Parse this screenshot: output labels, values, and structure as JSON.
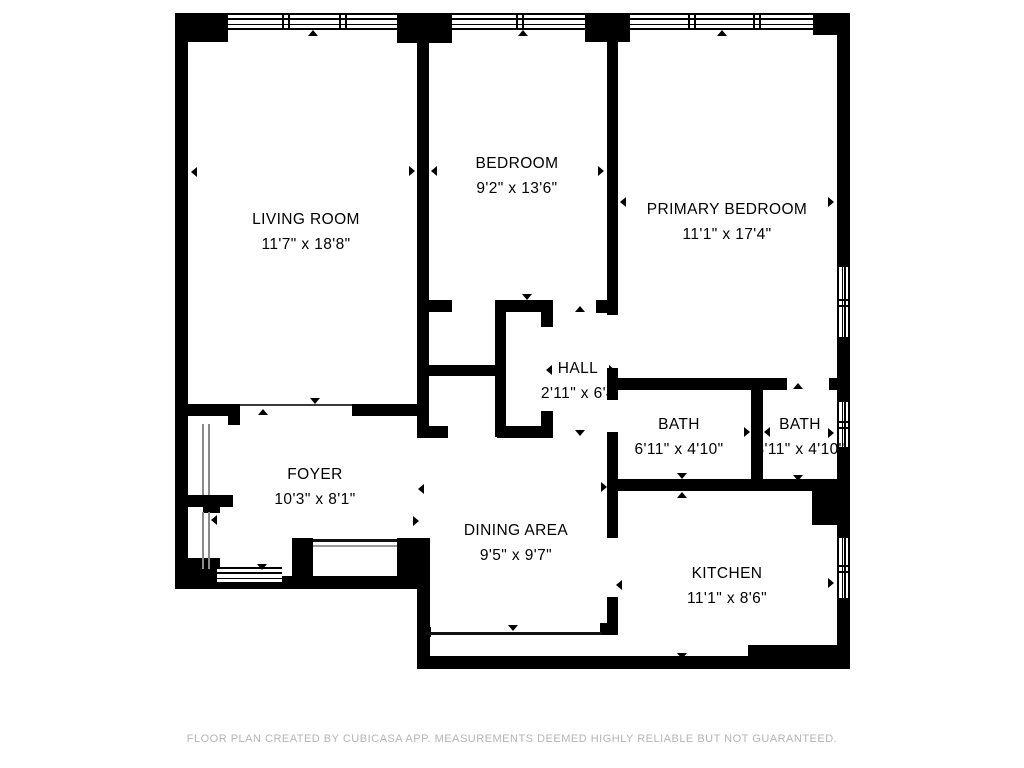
{
  "footer": {
    "text": "FLOOR PLAN CREATED BY CUBICASA APP. MEASUREMENTS DEEMED HIGHLY RELIABLE BUT NOT GUARANTEED."
  },
  "floorplan": {
    "colors": {
      "wall": "#000000",
      "opening_line": "#3a3a3a",
      "closet_line": "#8a8a8a",
      "entry_line": "#111111",
      "entry_line2": "#9a9a9a",
      "window_line": "#111111"
    },
    "rooms": [
      {
        "name": "LIVING ROOM",
        "dims": "11'7\" x 18'8\"",
        "cx": 306,
        "y": 207
      },
      {
        "name": "BEDROOM",
        "dims": "9'2\" x 13'6\"",
        "cx": 517,
        "y": 151
      },
      {
        "name": "PRIMARY BEDROOM",
        "dims": "11'1\" x 17'4\"",
        "cx": 727,
        "y": 197
      },
      {
        "name": "HALL",
        "dims": "2'11\" x 6'4",
        "cx": 578,
        "y": 356
      },
      {
        "name": "BATH",
        "dims": "6'11\" x 4'10\"",
        "cx": 679,
        "y": 412
      },
      {
        "name": "BATH",
        "dims": "3'11\" x 4'10\"",
        "cx": 800,
        "y": 412
      },
      {
        "name": "FOYER",
        "dims": "10'3\" x 8'1\"",
        "cx": 315,
        "y": 462
      },
      {
        "name": "DINING AREA",
        "dims": "9'5\" x 9'7\"",
        "cx": 516,
        "y": 518
      },
      {
        "name": "KITCHEN",
        "dims": "11'1\" x 8'6\"",
        "cx": 727,
        "y": 561
      }
    ],
    "walls": [
      [
        175,
        13,
        53,
        29
      ],
      [
        397,
        13,
        55,
        30
      ],
      [
        585,
        13,
        45,
        29
      ],
      [
        813,
        13,
        37,
        22
      ],
      [
        175,
        13,
        13,
        576
      ],
      [
        837,
        13,
        13,
        254
      ],
      [
        837,
        337,
        13,
        65
      ],
      [
        837,
        447,
        13,
        91
      ],
      [
        837,
        598,
        13,
        71
      ],
      [
        175,
        558,
        45,
        31
      ],
      [
        175,
        576,
        255,
        13
      ],
      [
        292,
        538,
        21,
        38
      ],
      [
        397,
        538,
        33,
        38
      ],
      [
        417,
        538,
        13,
        131
      ],
      [
        417,
        656,
        433,
        13
      ],
      [
        748,
        645,
        102,
        24
      ],
      [
        417,
        30,
        12,
        403
      ],
      [
        607,
        30,
        11,
        285
      ],
      [
        607,
        368,
        11,
        32
      ],
      [
        607,
        432,
        11,
        106
      ],
      [
        607,
        597,
        11,
        38
      ],
      [
        417,
        300,
        35,
        12
      ],
      [
        495,
        300,
        58,
        12
      ],
      [
        541,
        312,
        12,
        15
      ],
      [
        596,
        300,
        22,
        13
      ],
      [
        495,
        300,
        11,
        137
      ],
      [
        417,
        365,
        89,
        11
      ],
      [
        417,
        426,
        31,
        12
      ],
      [
        497,
        426,
        56,
        12
      ],
      [
        541,
        411,
        12,
        15
      ],
      [
        613,
        378,
        174,
        12
      ],
      [
        829,
        378,
        21,
        12
      ],
      [
        751,
        390,
        12,
        90
      ],
      [
        607,
        479,
        205,
        12
      ],
      [
        812,
        479,
        26,
        46
      ],
      [
        188,
        404,
        52,
        12
      ],
      [
        228,
        404,
        12,
        21
      ],
      [
        352,
        404,
        66,
        12
      ],
      [
        188,
        495,
        45,
        12
      ],
      [
        203,
        495,
        17,
        18
      ],
      [
        600,
        623,
        8,
        12
      ],
      [
        423,
        627,
        8,
        10
      ]
    ],
    "windows": [
      {
        "o": "h",
        "x": 228,
        "y": 13,
        "l": 169,
        "t": 17,
        "ticks": [
          54,
          111
        ]
      },
      {
        "o": "h",
        "x": 452,
        "y": 13,
        "l": 133,
        "t": 17,
        "ticks": [
          64
        ]
      },
      {
        "o": "h",
        "x": 630,
        "y": 13,
        "l": 183,
        "t": 17,
        "ticks": [
          58,
          123
        ]
      },
      {
        "o": "v",
        "x": 837,
        "y": 267,
        "l": 70,
        "t": 13,
        "ticks": [
          32
        ]
      },
      {
        "o": "v",
        "x": 837,
        "y": 402,
        "l": 45,
        "t": 13,
        "ticks": [
          19
        ]
      },
      {
        "o": "v",
        "x": 837,
        "y": 538,
        "l": 60,
        "t": 13,
        "ticks": [
          27
        ]
      },
      {
        "o": "h",
        "x": 217,
        "y": 567,
        "l": 65,
        "t": 17,
        "ticks": []
      }
    ],
    "lines": [
      {
        "x": 240,
        "y": 404,
        "w": 112,
        "h": 2,
        "c": "opening_line"
      },
      {
        "x": 202,
        "y": 424,
        "w": 2,
        "h": 71,
        "c": "closet_line"
      },
      {
        "x": 208,
        "y": 424,
        "w": 2,
        "h": 71,
        "c": "closet_line"
      },
      {
        "x": 202,
        "y": 512,
        "w": 2,
        "h": 57,
        "c": "closet_line"
      },
      {
        "x": 208,
        "y": 512,
        "w": 2,
        "h": 57,
        "c": "closet_line"
      },
      {
        "x": 313,
        "y": 539,
        "w": 84,
        "h": 3,
        "c": "entry_line"
      },
      {
        "x": 313,
        "y": 545,
        "w": 84,
        "h": 1.5,
        "c": "entry_line2"
      },
      {
        "x": 425,
        "y": 632,
        "w": 177,
        "h": 3,
        "c": "window_line"
      }
    ],
    "markers": [
      {
        "x": 313,
        "y": 33,
        "d": "up"
      },
      {
        "x": 523,
        "y": 33,
        "d": "up"
      },
      {
        "x": 722,
        "y": 33,
        "d": "up"
      },
      {
        "x": 194,
        "y": 172,
        "d": "left"
      },
      {
        "x": 412,
        "y": 171,
        "d": "right"
      },
      {
        "x": 434,
        "y": 171,
        "d": "left"
      },
      {
        "x": 601,
        "y": 171,
        "d": "right"
      },
      {
        "x": 623,
        "y": 202,
        "d": "left"
      },
      {
        "x": 831,
        "y": 202,
        "d": "right"
      },
      {
        "x": 527,
        "y": 297,
        "d": "down"
      },
      {
        "x": 580,
        "y": 309,
        "d": "up"
      },
      {
        "x": 549,
        "y": 370,
        "d": "left"
      },
      {
        "x": 612,
        "y": 370,
        "d": "right"
      },
      {
        "x": 517,
        "y": 435,
        "d": "up"
      },
      {
        "x": 580,
        "y": 433,
        "d": "down"
      },
      {
        "x": 682,
        "y": 385,
        "d": "up"
      },
      {
        "x": 682,
        "y": 476,
        "d": "down"
      },
      {
        "x": 682,
        "y": 495,
        "d": "up"
      },
      {
        "x": 604,
        "y": 487,
        "d": "right"
      },
      {
        "x": 747,
        "y": 432,
        "d": "right"
      },
      {
        "x": 767,
        "y": 432,
        "d": "left"
      },
      {
        "x": 798,
        "y": 386,
        "d": "up"
      },
      {
        "x": 798,
        "y": 478,
        "d": "down"
      },
      {
        "x": 831,
        "y": 433,
        "d": "right"
      },
      {
        "x": 619,
        "y": 585,
        "d": "left"
      },
      {
        "x": 831,
        "y": 583,
        "d": "right"
      },
      {
        "x": 682,
        "y": 656,
        "d": "down"
      },
      {
        "x": 513,
        "y": 628,
        "d": "down"
      },
      {
        "x": 421,
        "y": 489,
        "d": "left"
      },
      {
        "x": 416,
        "y": 521,
        "d": "right"
      },
      {
        "x": 315,
        "y": 401,
        "d": "down"
      },
      {
        "x": 263,
        "y": 412,
        "d": "up"
      },
      {
        "x": 214,
        "y": 520,
        "d": "left"
      },
      {
        "x": 262,
        "y": 567,
        "d": "down"
      }
    ]
  }
}
